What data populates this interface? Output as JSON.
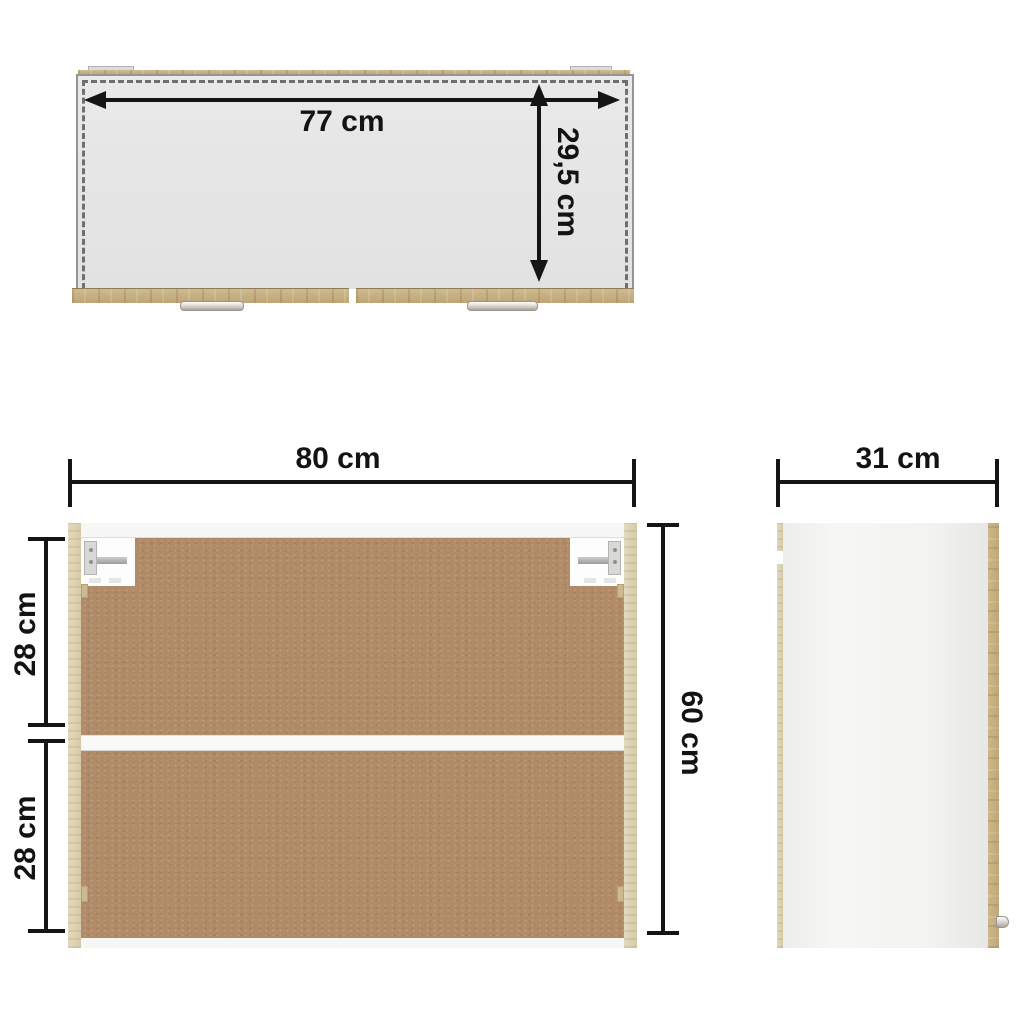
{
  "diagram": {
    "subject": "wall cabinet dimension drawing",
    "top_view": {
      "width_label": "77 cm",
      "depth_label": "29,5 cm"
    },
    "front_view": {
      "width_label": "80 cm",
      "height_label": "60 cm",
      "upper_compartment_label": "28 cm",
      "lower_compartment_label": "28 cm"
    },
    "side_view": {
      "depth_label": "31 cm"
    }
  },
  "colors": {
    "background": "#ffffff",
    "dimension_ink": "#151515",
    "top_panel_gray": "#e6e6e6",
    "oak": "#c6ae7f",
    "oak_pale": "#d9d0af",
    "mdf_brown": "#b18b67",
    "board_white": "#f7f7f5",
    "hardware_silver": "#c9c5be"
  }
}
